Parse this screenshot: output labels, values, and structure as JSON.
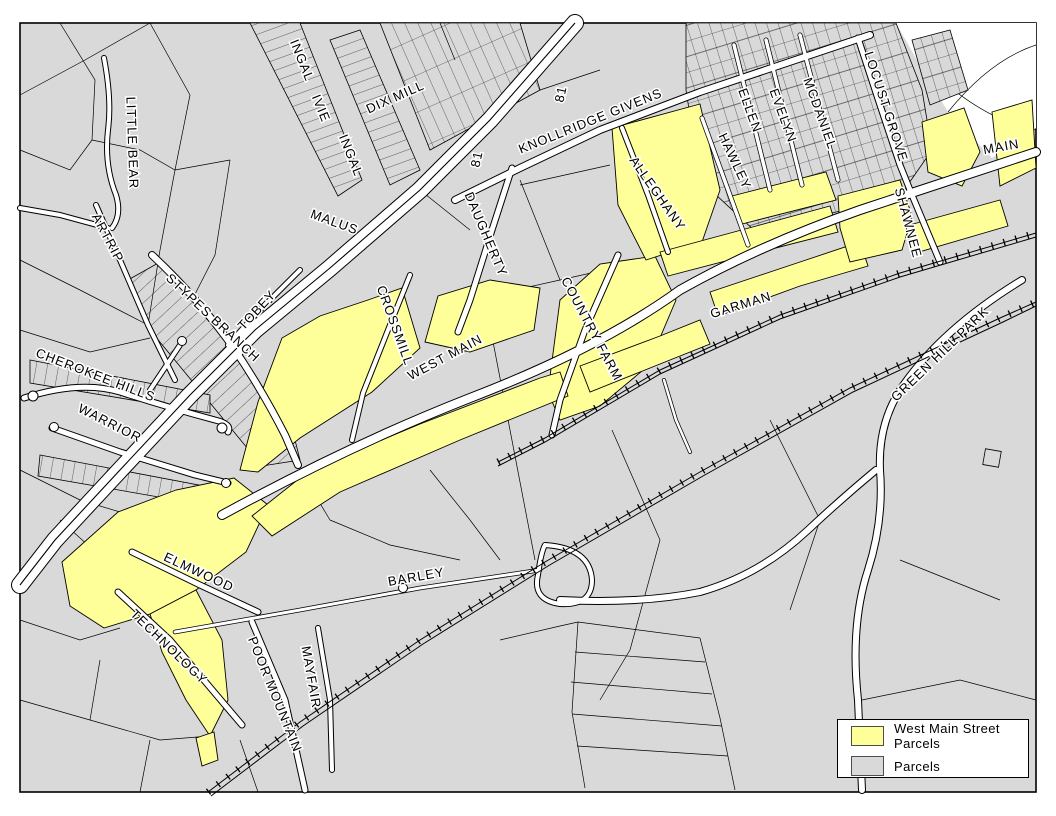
{
  "map": {
    "colors": {
      "parcel_fill": "#d9d9d9",
      "highlight_fill": "#ffff99",
      "road_fill": "#ffffff",
      "boundary_line": "#000000",
      "background": "#ffffff"
    },
    "labels": [
      {
        "text": "LITTLE BEAR",
        "x": 128,
        "y": 143,
        "rotate": 88
      },
      {
        "text": "ARTRIP",
        "x": 104,
        "y": 240,
        "rotate": 62
      },
      {
        "text": "INGAL",
        "x": 298,
        "y": 62,
        "rotate": 68
      },
      {
        "text": "IVIE",
        "x": 317,
        "y": 110,
        "rotate": 68
      },
      {
        "text": "INGAL",
        "x": 347,
        "y": 157,
        "rotate": 68
      },
      {
        "text": "DIX MILL",
        "x": 397,
        "y": 101,
        "rotate": -24
      },
      {
        "text": "81",
        "x": 565,
        "y": 95,
        "rotate": -78
      },
      {
        "text": "81",
        "x": 481,
        "y": 160,
        "rotate": -78
      },
      {
        "text": "KNOLLRIDGE GIVENS",
        "x": 592,
        "y": 125,
        "rotate": -22
      },
      {
        "text": "MALUS",
        "x": 333,
        "y": 226,
        "rotate": 20
      },
      {
        "text": "ALLEGHANY",
        "x": 654,
        "y": 196,
        "rotate": 55
      },
      {
        "text": "ELLEN",
        "x": 746,
        "y": 112,
        "rotate": 70
      },
      {
        "text": "EVELYN",
        "x": 779,
        "y": 117,
        "rotate": 70
      },
      {
        "text": "MCDANIEL",
        "x": 816,
        "y": 115,
        "rotate": 70
      },
      {
        "text": "HAWLEY",
        "x": 731,
        "y": 163,
        "rotate": 65
      },
      {
        "text": "LOCUST GROVE",
        "x": 882,
        "y": 108,
        "rotate": 72
      },
      {
        "text": "SHAWNEE",
        "x": 904,
        "y": 224,
        "rotate": 75
      },
      {
        "text": "MAIN",
        "x": 1002,
        "y": 151,
        "rotate": -10
      },
      {
        "text": "DAUGHERTY",
        "x": 482,
        "y": 236,
        "rotate": 67
      },
      {
        "text": "CROSSMILL",
        "x": 391,
        "y": 327,
        "rotate": 70
      },
      {
        "text": "WEST MAIN",
        "x": 447,
        "y": 361,
        "rotate": -28
      },
      {
        "text": "COUNTRY FARM",
        "x": 588,
        "y": 331,
        "rotate": 62
      },
      {
        "text": "GARMAN",
        "x": 742,
        "y": 309,
        "rotate": -17
      },
      {
        "text": "TOBEY",
        "x": 260,
        "y": 313,
        "rotate": -47
      },
      {
        "text": "STYPES BRANCH",
        "x": 210,
        "y": 321,
        "rotate": 43
      },
      {
        "text": "CHEROKEE HILLS",
        "x": 94,
        "y": 379,
        "rotate": 21
      },
      {
        "text": "WARRIOR",
        "x": 108,
        "y": 427,
        "rotate": 27
      },
      {
        "text": "GREEN HILL PARK",
        "x": 943,
        "y": 357,
        "rotate": -44
      },
      {
        "text": "ELMWOOD",
        "x": 197,
        "y": 576,
        "rotate": 25
      },
      {
        "text": "TECHNOLOGY",
        "x": 166,
        "y": 650,
        "rotate": 44
      },
      {
        "text": "POOR MOUNTAIN",
        "x": 271,
        "y": 696,
        "rotate": 68
      },
      {
        "text": "MAYFAIR",
        "x": 307,
        "y": 678,
        "rotate": 80
      },
      {
        "text": "BARLEY",
        "x": 417,
        "y": 581,
        "rotate": -10
      }
    ],
    "legend": {
      "items": [
        {
          "label": "West Main Street Parcels",
          "color": "#ffff99"
        },
        {
          "label": "Parcels",
          "color": "#d9d9d9"
        }
      ]
    }
  }
}
